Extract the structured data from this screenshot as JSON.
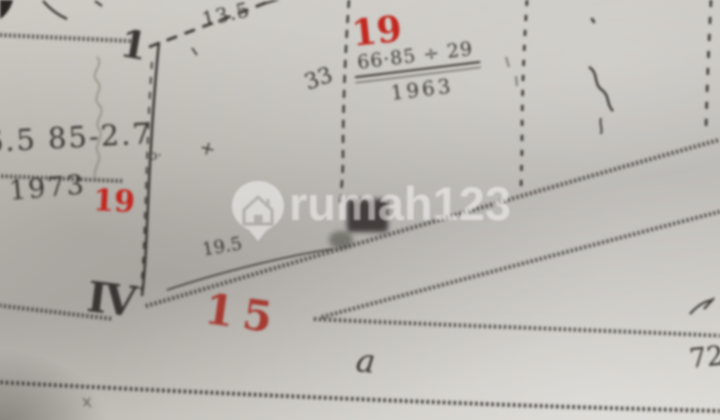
{
  "watermark": {
    "brand": "rumah123",
    "icon": "house-pin-icon"
  },
  "colors": {
    "paper": "#c2bfb9",
    "black_ink": "#3a3633",
    "red_ink_bright": "#c1271f",
    "red_ink_dark": "#a63a31",
    "watermark_text": "rgba(252,250,247,0.52)"
  },
  "annotations": {
    "point_top": "1",
    "dim_top": "13.5",
    "note_mid": "33",
    "parcel_top_red": "19",
    "fraction_numerator": "66·85 ÷ 29",
    "fraction_denominator": "1963",
    "note_left": "6.5 85-2.7",
    "year_left": "1973",
    "parcel_left_red": "19",
    "note_o": "o·",
    "mark_plus": "+",
    "dim_bottom": "19.5",
    "point_bottom": "IV",
    "parcel_bottom_red": "15",
    "road_letter": "a",
    "note_right": "72"
  }
}
